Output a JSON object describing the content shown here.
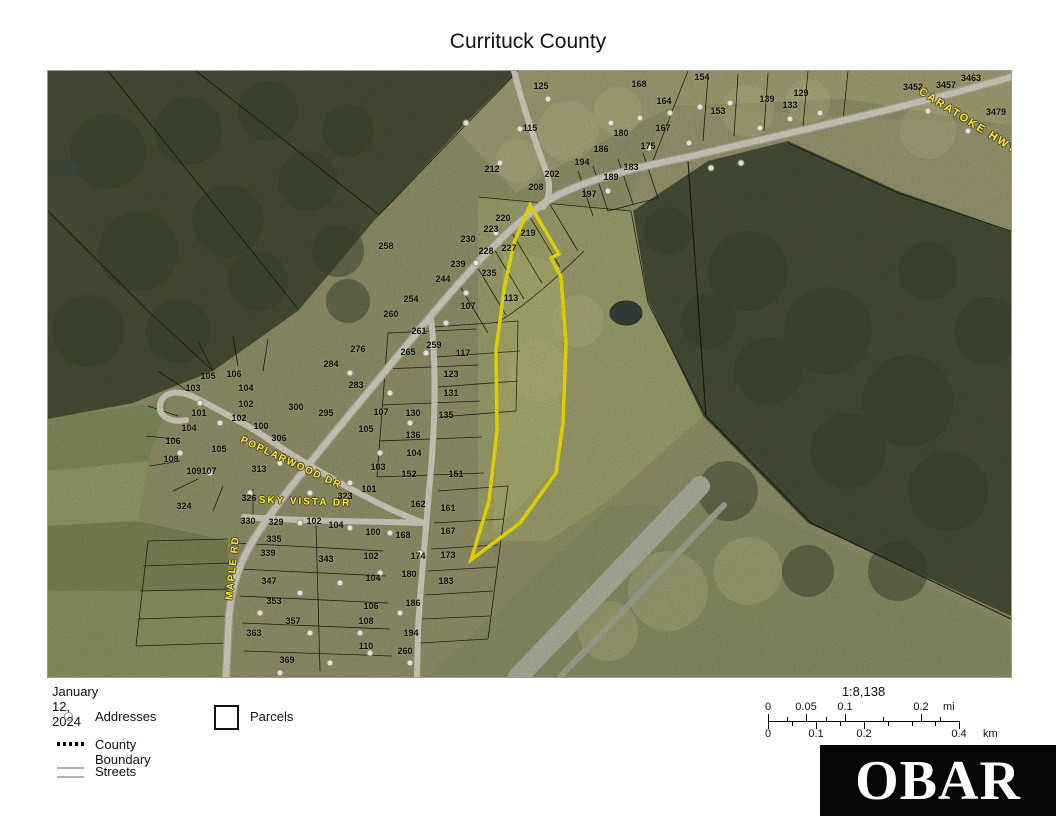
{
  "title": "Currituck County",
  "legend": {
    "date": "January 12, 2024",
    "items": [
      {
        "label": "Addresses",
        "symbol": "address-circle-icon"
      },
      {
        "label": "Parcels",
        "symbol": "parcel-square-icon"
      },
      {
        "label": "County Boundary",
        "symbol": "dotted-line-icon"
      },
      {
        "label": "Streets",
        "symbol": "double-line-icon"
      }
    ]
  },
  "scalebar": {
    "ratio": "1:8,138",
    "mi_unit": "mi",
    "km_unit": "km",
    "mi_ticks": [
      {
        "label": "0",
        "x": 0
      },
      {
        "label": "0.05",
        "x": 38
      },
      {
        "label": "0.1",
        "x": 77
      },
      {
        "label": "0.2",
        "x": 153
      }
    ],
    "km_ticks": [
      {
        "label": "0",
        "x": 0
      },
      {
        "label": "0.1",
        "x": 48
      },
      {
        "label": "0.2",
        "x": 96
      },
      {
        "label": "0.4",
        "x": 191
      }
    ]
  },
  "logo": {
    "text": "OBAR"
  },
  "map": {
    "highlight_color": "#ffee00",
    "street_labels": [
      {
        "text": "CARATOKE HWY",
        "x": 920,
        "y": 50,
        "angle": 32,
        "spacing": 2,
        "size": 11
      },
      {
        "text": "POPLARWOOD DR",
        "x": 243,
        "y": 392,
        "angle": 25,
        "spacing": 1.5,
        "size": 10
      },
      {
        "text": "SKY VISTA DR",
        "x": 257,
        "y": 431,
        "angle": 2,
        "spacing": 2,
        "size": 10
      },
      {
        "text": "MAPLE RD",
        "x": 185,
        "y": 497,
        "angle": -84,
        "spacing": 1.5,
        "size": 10
      }
    ],
    "parcel_labels": [
      {
        "t": "125",
        "x": 493,
        "y": 15
      },
      {
        "t": "168",
        "x": 591,
        "y": 13
      },
      {
        "t": "164",
        "x": 616,
        "y": 30
      },
      {
        "t": "154",
        "x": 654,
        "y": 6
      },
      {
        "t": "153",
        "x": 670,
        "y": 40
      },
      {
        "t": "139",
        "x": 719,
        "y": 28
      },
      {
        "t": "133",
        "x": 742,
        "y": 34
      },
      {
        "t": "129",
        "x": 753,
        "y": 22
      },
      {
        "t": "115",
        "x": 482,
        "y": 57
      },
      {
        "t": "180",
        "x": 573,
        "y": 62
      },
      {
        "t": "167",
        "x": 615,
        "y": 57
      },
      {
        "t": "186",
        "x": 553,
        "y": 78
      },
      {
        "t": "175",
        "x": 600,
        "y": 75
      },
      {
        "t": "194",
        "x": 534,
        "y": 91
      },
      {
        "t": "183",
        "x": 583,
        "y": 96
      },
      {
        "t": "212",
        "x": 444,
        "y": 98
      },
      {
        "t": "202",
        "x": 504,
        "y": 103
      },
      {
        "t": "189",
        "x": 563,
        "y": 106
      },
      {
        "t": "208",
        "x": 488,
        "y": 116
      },
      {
        "t": "197",
        "x": 541,
        "y": 123
      },
      {
        "t": "3452",
        "x": 865,
        "y": 16
      },
      {
        "t": "3457",
        "x": 898,
        "y": 14
      },
      {
        "t": "3463",
        "x": 923,
        "y": 7
      },
      {
        "t": "3479",
        "x": 948,
        "y": 41
      },
      {
        "t": "258",
        "x": 338,
        "y": 175
      },
      {
        "t": "220",
        "x": 455,
        "y": 147
      },
      {
        "t": "223",
        "x": 443,
        "y": 158
      },
      {
        "t": "219",
        "x": 480,
        "y": 162
      },
      {
        "t": "230",
        "x": 420,
        "y": 168
      },
      {
        "t": "228",
        "x": 438,
        "y": 180
      },
      {
        "t": "227",
        "x": 461,
        "y": 177
      },
      {
        "t": "239",
        "x": 410,
        "y": 193
      },
      {
        "t": "235",
        "x": 441,
        "y": 202
      },
      {
        "t": "244",
        "x": 395,
        "y": 208
      },
      {
        "t": "254",
        "x": 363,
        "y": 228
      },
      {
        "t": "260",
        "x": 343,
        "y": 243
      },
      {
        "t": "261",
        "x": 371,
        "y": 260
      },
      {
        "t": "107",
        "x": 420,
        "y": 235
      },
      {
        "t": "113",
        "x": 463,
        "y": 227
      },
      {
        "t": "276",
        "x": 310,
        "y": 278
      },
      {
        "t": "284",
        "x": 283,
        "y": 293
      },
      {
        "t": "265",
        "x": 360,
        "y": 281
      },
      {
        "t": "259",
        "x": 386,
        "y": 274
      },
      {
        "t": "117",
        "x": 415,
        "y": 282
      },
      {
        "t": "123",
        "x": 403,
        "y": 303
      },
      {
        "t": "283",
        "x": 308,
        "y": 314
      },
      {
        "t": "131",
        "x": 403,
        "y": 322
      },
      {
        "t": "300",
        "x": 248,
        "y": 336
      },
      {
        "t": "295",
        "x": 278,
        "y": 342
      },
      {
        "t": "107",
        "x": 333,
        "y": 341
      },
      {
        "t": "130",
        "x": 365,
        "y": 342
      },
      {
        "t": "135",
        "x": 398,
        "y": 344
      },
      {
        "t": "105",
        "x": 318,
        "y": 358
      },
      {
        "t": "136",
        "x": 365,
        "y": 364
      },
      {
        "t": "104",
        "x": 366,
        "y": 382
      },
      {
        "t": "103",
        "x": 330,
        "y": 396
      },
      {
        "t": "152",
        "x": 361,
        "y": 403
      },
      {
        "t": "151",
        "x": 408,
        "y": 403
      },
      {
        "t": "101",
        "x": 321,
        "y": 418
      },
      {
        "t": "323",
        "x": 297,
        "y": 425
      },
      {
        "t": "162",
        "x": 370,
        "y": 433
      },
      {
        "t": "161",
        "x": 400,
        "y": 437
      },
      {
        "t": "104",
        "x": 288,
        "y": 454
      },
      {
        "t": "100",
        "x": 325,
        "y": 461
      },
      {
        "t": "168",
        "x": 355,
        "y": 464
      },
      {
        "t": "167",
        "x": 400,
        "y": 460
      },
      {
        "t": "102",
        "x": 323,
        "y": 485
      },
      {
        "t": "174",
        "x": 370,
        "y": 485
      },
      {
        "t": "173",
        "x": 400,
        "y": 484
      },
      {
        "t": "105",
        "x": 160,
        "y": 305
      },
      {
        "t": "106",
        "x": 186,
        "y": 303
      },
      {
        "t": "103",
        "x": 145,
        "y": 317
      },
      {
        "t": "104",
        "x": 198,
        "y": 317
      },
      {
        "t": "102",
        "x": 198,
        "y": 333
      },
      {
        "t": "101",
        "x": 151,
        "y": 342
      },
      {
        "t": "102",
        "x": 191,
        "y": 347
      },
      {
        "t": "104",
        "x": 141,
        "y": 357
      },
      {
        "t": "106",
        "x": 125,
        "y": 370
      },
      {
        "t": "105",
        "x": 171,
        "y": 378
      },
      {
        "t": "108",
        "x": 123,
        "y": 388
      },
      {
        "t": "109",
        "x": 146,
        "y": 400
      },
      {
        "t": "107",
        "x": 161,
        "y": 400
      },
      {
        "t": "100",
        "x": 213,
        "y": 355
      },
      {
        "t": "306",
        "x": 231,
        "y": 367
      },
      {
        "t": "313",
        "x": 211,
        "y": 398
      },
      {
        "t": "326",
        "x": 201,
        "y": 427
      },
      {
        "t": "324",
        "x": 136,
        "y": 435
      },
      {
        "t": "330",
        "x": 200,
        "y": 450
      },
      {
        "t": "329",
        "x": 228,
        "y": 451
      },
      {
        "t": "102",
        "x": 266,
        "y": 450
      },
      {
        "t": "335",
        "x": 226,
        "y": 468
      },
      {
        "t": "339",
        "x": 220,
        "y": 482
      },
      {
        "t": "343",
        "x": 278,
        "y": 488
      },
      {
        "t": "347",
        "x": 221,
        "y": 510
      },
      {
        "t": "353",
        "x": 226,
        "y": 530
      },
      {
        "t": "357",
        "x": 245,
        "y": 550
      },
      {
        "t": "363",
        "x": 206,
        "y": 562
      },
      {
        "t": "369",
        "x": 239,
        "y": 589
      },
      {
        "t": "104",
        "x": 325,
        "y": 507
      },
      {
        "t": "106",
        "x": 323,
        "y": 535
      },
      {
        "t": "108",
        "x": 318,
        "y": 550
      },
      {
        "t": "110",
        "x": 318,
        "y": 575
      },
      {
        "t": "180",
        "x": 361,
        "y": 503
      },
      {
        "t": "183",
        "x": 398,
        "y": 510
      },
      {
        "t": "186",
        "x": 365,
        "y": 532
      },
      {
        "t": "194",
        "x": 363,
        "y": 562
      },
      {
        "t": "260",
        "x": 357,
        "y": 580
      }
    ],
    "address_points": [
      [
        500,
        28
      ],
      [
        472,
        58
      ],
      [
        452,
        92
      ],
      [
        563,
        52
      ],
      [
        592,
        47
      ],
      [
        622,
        42
      ],
      [
        652,
        36
      ],
      [
        682,
        32
      ],
      [
        712,
        57
      ],
      [
        742,
        48
      ],
      [
        772,
        42
      ],
      [
        641,
        72
      ],
      [
        601,
        77
      ],
      [
        663,
        97
      ],
      [
        693,
        92
      ],
      [
        880,
        40
      ],
      [
        920,
        60
      ],
      [
        448,
        162
      ],
      [
        428,
        192
      ],
      [
        418,
        222
      ],
      [
        398,
        252
      ],
      [
        378,
        282
      ],
      [
        302,
        302
      ],
      [
        342,
        322
      ],
      [
        362,
        352
      ],
      [
        332,
        382
      ],
      [
        302,
        412
      ],
      [
        262,
        422
      ],
      [
        232,
        392
      ],
      [
        202,
        372
      ],
      [
        172,
        352
      ],
      [
        152,
        332
      ],
      [
        132,
        382
      ],
      [
        162,
        402
      ],
      [
        202,
        422
      ],
      [
        252,
        452
      ],
      [
        302,
        457
      ],
      [
        342,
        462
      ],
      [
        372,
        482
      ],
      [
        332,
        502
      ],
      [
        292,
        512
      ],
      [
        252,
        522
      ],
      [
        212,
        542
      ],
      [
        262,
        562
      ],
      [
        312,
        562
      ],
      [
        352,
        542
      ],
      [
        322,
        582
      ],
      [
        282,
        592
      ],
      [
        232,
        602
      ],
      [
        362,
        592
      ],
      [
        418,
        52
      ],
      [
        560,
        120
      ]
    ]
  }
}
